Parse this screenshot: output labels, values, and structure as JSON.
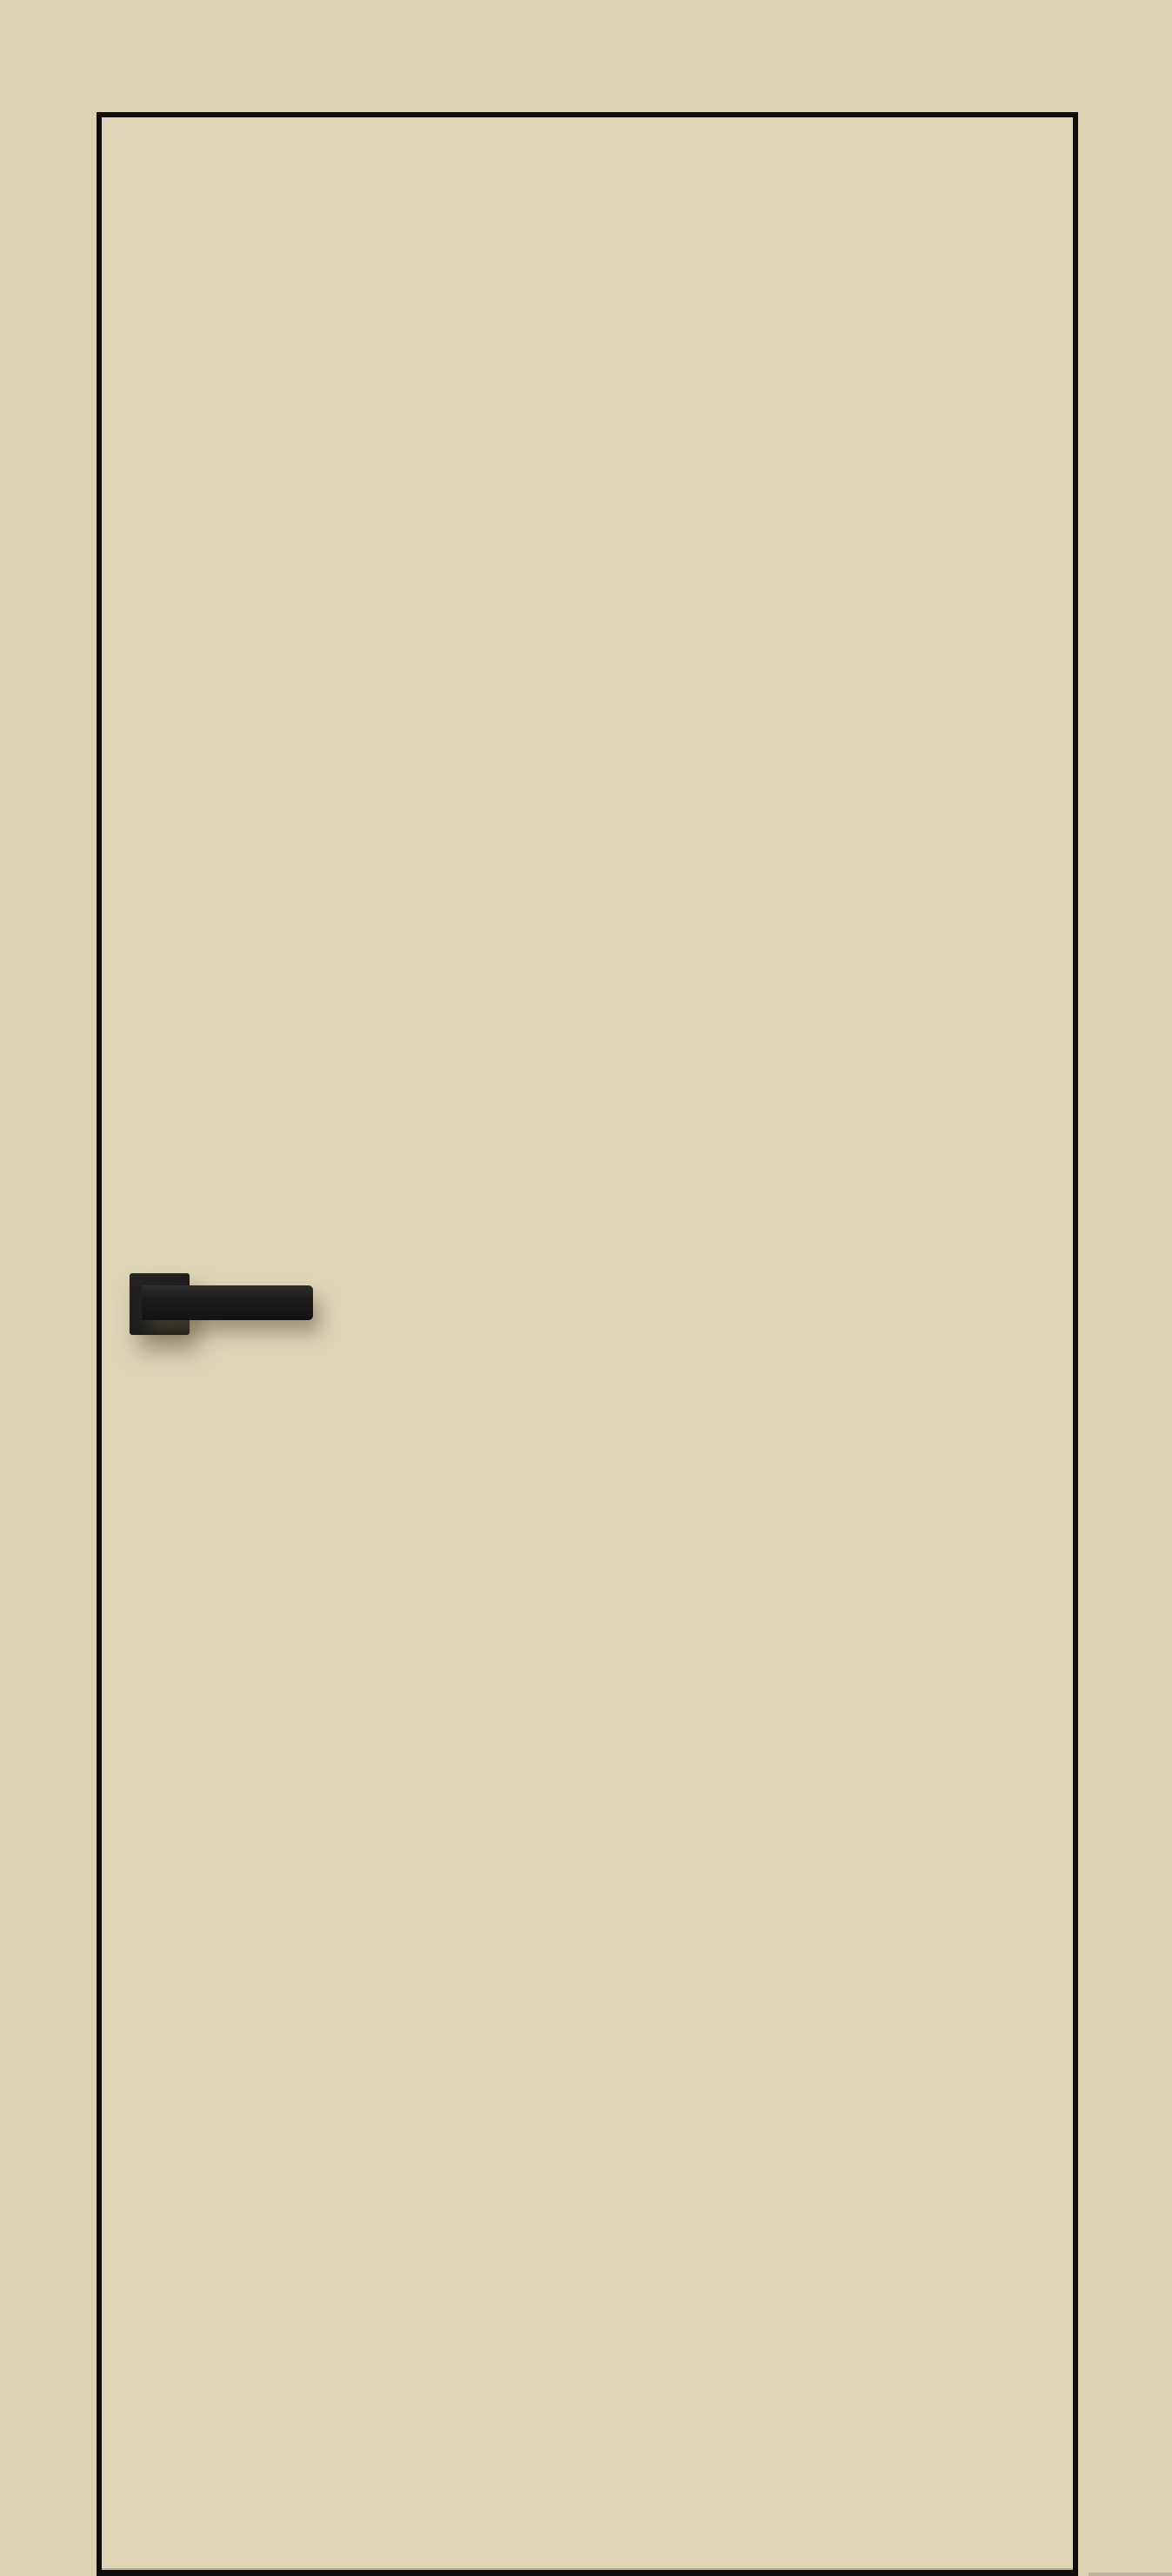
{
  "scene": {
    "type": "product-image",
    "subject": "flush-interior-door",
    "description": "Frameless flush interior door panel in beige finish with thin black aluminium edge trim and a matte black square-rose lever handle mounted on the left side; no visible text",
    "objects": {
      "door_panel": "beige flush door leaf outlined by thin black edge trim, bottom edge touching image bottom",
      "handle_rose": "square black backplate",
      "handle_lever": "straight rectangular black lever pointing right",
      "floor_shadow": "faint shadow line at bottom right of door"
    },
    "colors": {
      "background": "#dcd3b5",
      "door_face": "#ded5b7",
      "door_trim": "#0f0f0f",
      "handle_dark": "#1c1c1c",
      "handle_mid": "#242424",
      "handle_light": "#303030",
      "shadow": "rgba(100,90,62,.5)",
      "floor_shadow": "rgba(0,0,0,.14)"
    }
  }
}
